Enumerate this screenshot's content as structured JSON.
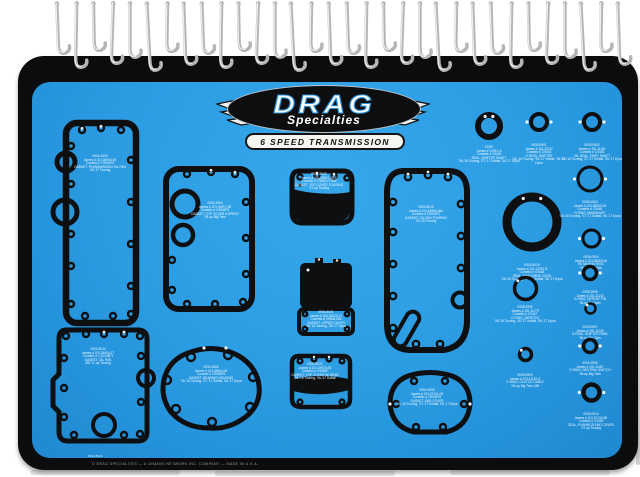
{
  "brand": {
    "name_top": "DRAG",
    "name_bottom": "Specialties",
    "subtitle": "6 SPEED TRANSMISSION"
  },
  "board": {
    "color": "#2d9ee4",
    "edge_color": "#0b0c0e",
    "footer_note": "© DRAG SPECIALTIES — A LEMANS NETWORK INC. COMPANY — MADE IN U.S.A.",
    "footer_part": "0934-5024"
  },
  "hooks": {
    "count": 32
  },
  "gaskets": [
    {
      "id": "transmission-oil-pan-gasket",
      "shape": "A",
      "x": 23,
      "y": 32,
      "w": 90,
      "h": 218,
      "lx": 45,
      "ly": 41,
      "lw": 78,
      "label": "0934-4553\nJames # JGI-34904-06\nCometic # C9503F5\nGASKET, TRANSMISSION OIL PAN\n'06-'17 Touring"
    },
    {
      "id": "top-cover-gasket",
      "shape": "B",
      "x": 125,
      "y": 78,
      "w": 104,
      "h": 158,
      "lx": 58,
      "ly": 42,
      "lw": 82,
      "label": "0934-4554\nJames # JGI-34917-06\nCometic # C9502F5\nGASKET, TOP COVER 6-SPEED\n'06-up Big Twin"
    },
    {
      "id": "top-cover-touring-gasket",
      "shape": "C",
      "x": 251,
      "y": 80,
      "w": 76,
      "h": 70,
      "lx": 36,
      "ly": 11,
      "lw": 64,
      "label": "0934-5020\nJames # JGI-34917-06-X\nCometic # C9502-FOAM\nGASKET, TOP COVER TOURING\n'17-up Touring"
    },
    {
      "id": "upper-cover-gasket",
      "shape": "D",
      "x": 261,
      "y": 170,
      "w": 66,
      "h": 86,
      "lx": 33,
      "ly": 59,
      "lw": 52,
      "label": "0934-5021\nJames # JGI-34923-17\nCometic # C9506-565\nGASKET, UPPER COVER\n'06-'16 Touring, '06-'17 Dyna"
    },
    {
      "id": "top-cover-bead-gasket",
      "shape": "E",
      "x": 254,
      "y": 266,
      "w": 70,
      "h": 66,
      "lx": 29,
      "ly": 15,
      "lw": 58,
      "label": "0934-5022\nJames # JGI-34923-06\nCometic # C9506F\nGASKET, TOP COVER W/ BEAD\n'06-'16 Touring, '06-'17 Softail"
    },
    {
      "id": "end-cover-gasket",
      "shape": "F",
      "x": 351,
      "y": 284,
      "w": 94,
      "h": 74,
      "lx": 44,
      "ly": 23,
      "lw": 72,
      "label": "0934-4556\nJames # JGI-37101-06\nCometic # C9504F5\nGASKET, END COVER\n'06-'16 Touring, '07-'17 Softail, '06-'17 Dyna"
    },
    {
      "id": "bearing-housing-gasket",
      "shape": "G",
      "x": 120,
      "y": 260,
      "w": 118,
      "h": 94,
      "lx": 59,
      "ly": 24,
      "lw": 84,
      "label": "0934-4555\nJames # JGI-35654-06\nCometic # C9505F5\nGASKET, BEARING HOUSING\n'06-'16 Touring, '07-'17 Softail, '06-'17 Dyna"
    },
    {
      "id": "oil-pan-m8-gasket",
      "shape": "H",
      "x": 12,
      "y": 240,
      "w": 112,
      "h": 128,
      "lx": 54,
      "ly": 26,
      "lw": 84,
      "label": "0934-5014\nJames # JGI-34904-17\nCometic # C10138F1\nGASKET, OIL PAN\nM8 '17-up Touring"
    },
    {
      "id": "oil-pan-touring-gasket",
      "shape": "I",
      "x": 342,
      "y": 80,
      "w": 106,
      "h": 202,
      "lx": 52,
      "ly": 44,
      "lw": 84,
      "label": "0934-5015\nJames # JGI-34904-06A\nCometic # C9503F1\nGASKET, OIL PAN TOURING\n'06-'16 Touring"
    }
  ],
  "parts": [
    {
      "id": "shifter-shaft-seal",
      "cx": 457,
      "cy": 44,
      "r": 11,
      "sw": 6,
      "glints": "top",
      "lt": 64,
      "lw": 62,
      "label": "12067\nJames # 12067-A\nCometic # C9443\nSEAL, SHIFTER SHAFT\n'06-'16 Touring, '07-'17 Softail, '06-'17 Dyna"
    },
    {
      "id": "shifter-o-ring",
      "cx": 507,
      "cy": 40,
      "r": 8,
      "sw": 4,
      "glints": "sides",
      "lt": 62,
      "lw": 60,
      "label": "0935-0901\nJames # JGI-11132\nCometic # C9444\nO-RING, SHIFTER\n'06-'16 Touring, '06-'17 Softail, '06-'17 Dyna"
    },
    {
      "id": "shift-shaft-oil-seal",
      "cx": 560,
      "cy": 40,
      "r": 8,
      "sw": 4,
      "glints": "sides",
      "lt": 62,
      "lw": 64,
      "label": "0935-0902\nJames # JGI-11161\nCometic # C9445\nOIL SEAL, SHIFT SHAFT\n'06-'16 Touring, '07-'17 Softail, '06-'17 Dyna"
    },
    {
      "id": "main-drive-gear-seal",
      "cx": 500,
      "cy": 140,
      "r": 25,
      "sw": 9,
      "glints": "top",
      "lt": 182,
      "lw": 70,
      "label": "0934-5019\nJames # JGI-12067-B\nCometic # C9448\nSEAL, MAIN DRIVE GEAR\n'06-'16 Touring, '07-'17 Softail, '06-'17 Dyna"
    },
    {
      "id": "mainshaft-o-ring",
      "cx": 558,
      "cy": 97,
      "r": 12,
      "sw": 3,
      "glints": "sides",
      "lt": 119,
      "lw": 72,
      "label": "0935-0903\nJames # JGI-35652-06\nCometic # C9446\nO-RING, MAINSHAFT\n'06-'16 Touring, '07-'17 Softail, '06-'17 Dyna"
    },
    {
      "id": "retaining-ring",
      "cx": 559,
      "cy": 156,
      "r": 8.5,
      "sw": 3,
      "glints": "sides",
      "lt": 174,
      "lw": 70,
      "label": "0935-0904\nJames # JGI-35656-06\nRETAINING RING\n'06-'17 Big Twin"
    },
    {
      "id": "dipstick-o-ring",
      "cx": 493,
      "cy": 206,
      "r": 11,
      "sw": 3.5,
      "glints": "topleft",
      "lt": 224,
      "lw": 66,
      "label": "0935-0905\nJames # JGI-11179\nCometic # C9447\nO-RING, DIPSTICK\n'06-'16 Touring, '06-'17 Softail, '06-'17 Dyna"
    },
    {
      "id": "detent-pin-o-ring",
      "cx": 558,
      "cy": 191,
      "r": 6.5,
      "sw": 3.5,
      "glints": "sides",
      "lt": 209,
      "lw": 72,
      "label": "0935-0906\nJames # JGI-11100\nO-RING, DETENT PIN\n'06-up Big Twin"
    },
    {
      "id": "shifter-pawl-o-ring",
      "cx": 558,
      "cy": 226,
      "r": 5,
      "sw": 2.5,
      "glints": "topleft",
      "lt": 244,
      "lw": 74,
      "label": "0935-0907\nJames # JGI-11105\nO-RING, SHIFTER PAWL\n'06-up Big Twin"
    },
    {
      "id": "neutral-switch-o-ring",
      "cx": 558,
      "cy": 264,
      "r": 6.5,
      "sw": 3.5,
      "glints": "sides",
      "lt": 280,
      "lw": 70,
      "label": "0935-0908\nJames # JGI-11187\nO-RING, NEUTRAL SWITCH\n'06-up Big Twin"
    },
    {
      "id": "clutch-cable-o-ring",
      "cx": 493,
      "cy": 272,
      "r": 6,
      "sw": 3.5,
      "glints": "topleft",
      "lt": 292,
      "lw": 70,
      "label": "0935-0909\nJames # JGI-11132-A\nO-RING, CLUTCH CABLE\n'06-up Big Twin, M8"
    },
    {
      "id": "pushrod-end-cover-seal",
      "cx": 559,
      "cy": 310,
      "r": 8,
      "sw": 4.5,
      "glints": "sides",
      "lt": 331,
      "lw": 72,
      "label": "0935-0910\nJames # JGI-37133-98\nCometic # C9449\nSEAL, PUSHROD END COVER\n'07-up Touring"
    }
  ]
}
